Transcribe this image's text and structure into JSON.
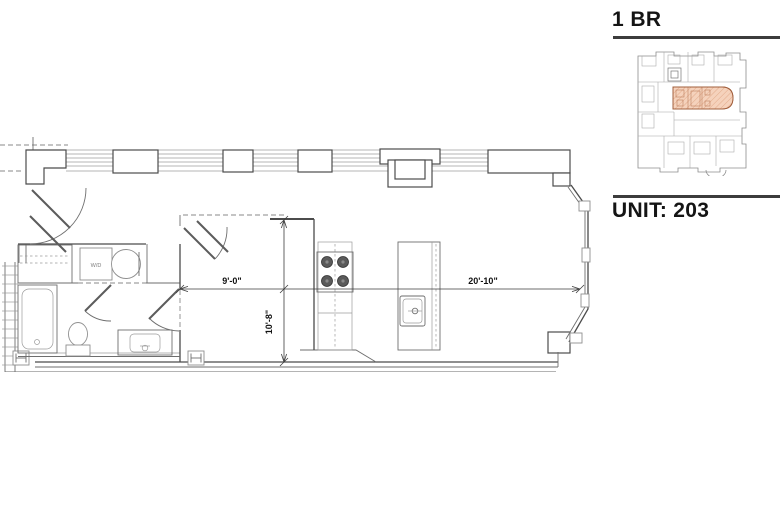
{
  "panel": {
    "unit_type": "1 BR",
    "unit_label": "UNIT: 203"
  },
  "floor_plan": {
    "dimensions": {
      "bedroom_width": "9'-0\"",
      "bedroom_depth": "10'-8\"",
      "living_length": "20'-10\""
    },
    "labels": {
      "washer_dryer": "W/D"
    }
  },
  "key_plan": {
    "highlighted_unit": "203",
    "highlight_fill": "#f5d2bc",
    "hatch_color": "#e2ab8b",
    "highlight_stroke": "#a2603e"
  },
  "colors": {
    "wall_dark": "#4c4c4c",
    "wall_mid": "#6e6e6e",
    "wall_light": "#9b9b9b",
    "heading_text": "#141414",
    "rule": "#3c3c3c"
  }
}
